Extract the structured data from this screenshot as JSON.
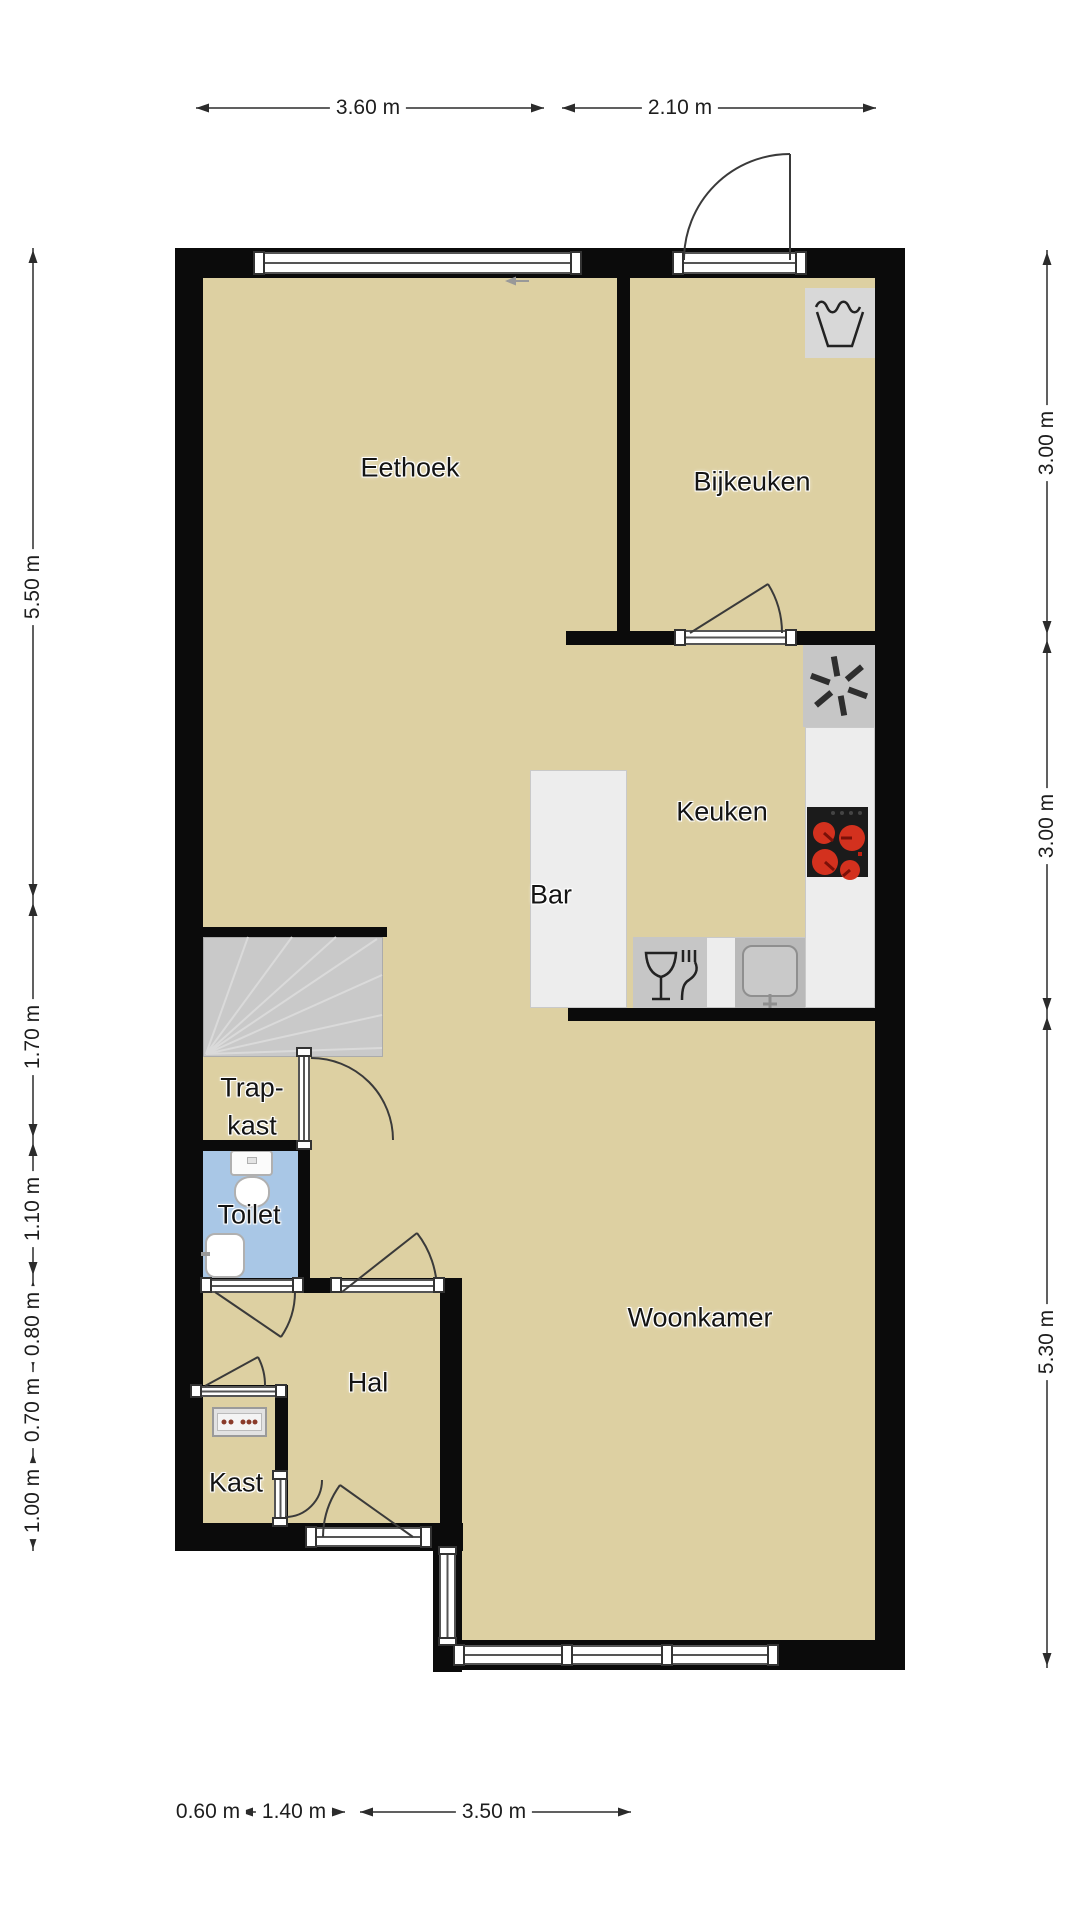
{
  "plan": {
    "rooms": {
      "eethoek": "Eethoek",
      "bijkeuken": "Bijkeuken",
      "keuken": "Keuken",
      "bar": "Bar",
      "trapkast_line1": "Trap-",
      "trapkast_line2": "kast",
      "toilet": "Toilet",
      "woonkamer": "Woonkamer",
      "hal": "Hal",
      "kast": "Kast"
    }
  },
  "dimensions": {
    "top": [
      "3.60 m",
      "2.10 m"
    ],
    "right": [
      "3.00 m",
      "3.00 m",
      "5.30 m"
    ],
    "left": [
      "5.50 m",
      "1.70 m",
      "1.10 m",
      "0.80 m",
      "0.70 m",
      "1.00 m"
    ],
    "bottom": [
      "0.60 m",
      "1.40 m",
      "3.50 m"
    ]
  },
  "icons": {
    "washing_machine": "washing-machine-icon",
    "extractor_fan": "extractor-fan-icon",
    "stove": "stove-icon",
    "sink": "sink-icon",
    "dishwasher": "dishwasher-icon",
    "toilet_fixture": "toilet-icon",
    "washbasin": "washbasin-icon",
    "meter_cabinet": "meter-cabinet-icon",
    "stairs": "stairs-icon"
  },
  "colors": {
    "floor": "#ddd0a2",
    "wall": "#0b0b0b",
    "toilet_floor": "#a9c7e6",
    "stairs": "#c9c9c9",
    "counter": "#ededed",
    "appliance_grey": "#c6c6c6",
    "sink_grey": "#b9b9b9",
    "washer_grey": "#d8d8d8",
    "stove_black": "#1b1b1b",
    "burner_red": "#d3311e",
    "door_line": "#3a3a3a",
    "dim_line": "#2b2b2b",
    "glass_line": "#555555"
  }
}
